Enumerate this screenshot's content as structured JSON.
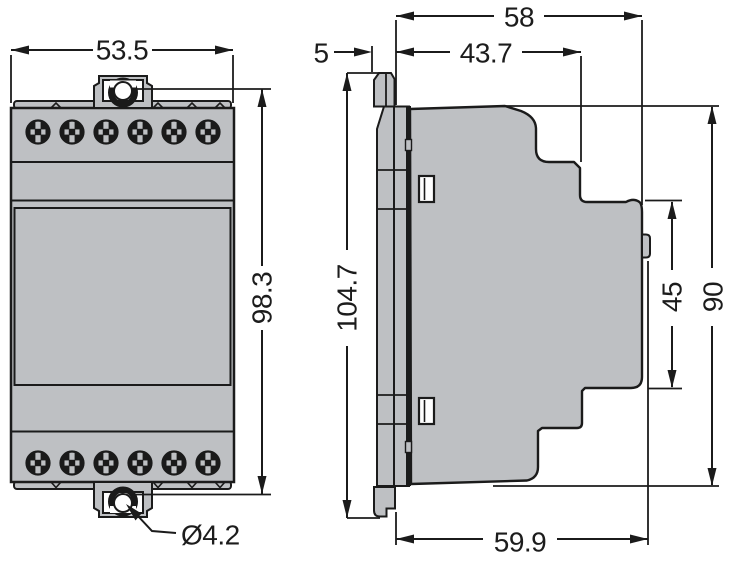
{
  "colors": {
    "body_fill": "#bec0c3",
    "line": "#1b1b1b",
    "text": "#1c1c1c",
    "window": "#ffffff"
  },
  "front_view": {
    "width": "53.5",
    "height": "98.3",
    "hole_diameter": "Ø4.2"
  },
  "side_view": {
    "overall_depth": "58",
    "upper_depth": "43.7",
    "front_lip": "5",
    "overall_height": "104.7",
    "din_recess_height": "45",
    "front_height": "90",
    "lower_depth": "59.9"
  }
}
